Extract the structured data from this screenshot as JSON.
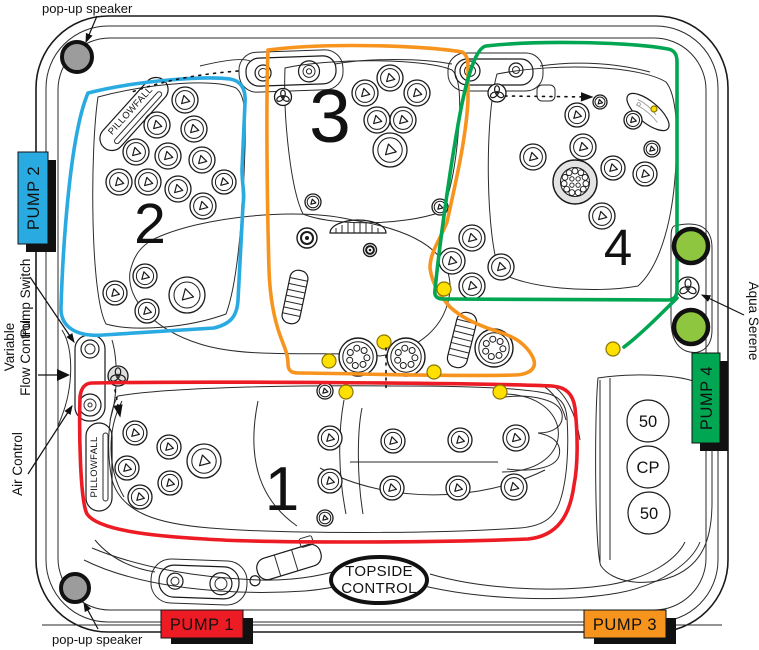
{
  "colors": {
    "line": "#1a1a1a",
    "speaker_gray": "#9c9c9c",
    "led_yellow": "#ffe000",
    "led_outline": "#8a7500",
    "light_green": "#8ec63f",
    "jet_gray": "#e3e3e3"
  },
  "labels": {
    "popup_speaker_top": "pop-up speaker",
    "popup_speaker_bottom": "pop-up speaker",
    "pillowfall_upper": "PILLOWFALL",
    "pillowfall_lower": "PILLOWFALL",
    "pump_switch": "Pump Switch",
    "variable": "Variable",
    "flow_control": "Flow Control",
    "air_control": "Air Control",
    "aqua_serene": "Aqua Serene",
    "topside_line1": "TOPSIDE",
    "topside_line2": "CONTROL"
  },
  "pumps": {
    "pump1": {
      "label": "PUMP 1",
      "color": "#ed1c24"
    },
    "pump2": {
      "label": "PUMP 2",
      "color": "#29abe2"
    },
    "pump3": {
      "label": "PUMP 3",
      "color": "#f7941d"
    },
    "pump4": {
      "label": "PUMP 4",
      "color": "#00a651"
    }
  },
  "zones": {
    "zone1": {
      "number": "1",
      "color": "#ed1c24"
    },
    "zone2": {
      "number": "2",
      "color": "#29abe2"
    },
    "zone3": {
      "number": "3",
      "color": "#f7941d"
    },
    "zone4": {
      "number": "4",
      "color": "#00a651"
    }
  },
  "filter_caps": [
    "50",
    "CP",
    "50"
  ],
  "jets": {
    "standard": [
      [
        185,
        100,
        13
      ],
      [
        157,
        125,
        13
      ],
      [
        194,
        129,
        13
      ],
      [
        136,
        152,
        13
      ],
      [
        168,
        156,
        13
      ],
      [
        202,
        160,
        13
      ],
      [
        119,
        182,
        13
      ],
      [
        148,
        182,
        13
      ],
      [
        178,
        189,
        13
      ],
      [
        224,
        182,
        12
      ],
      [
        203,
        206,
        13
      ],
      [
        145,
        276,
        12
      ],
      [
        115,
        293,
        12
      ],
      [
        147,
        311,
        12
      ],
      [
        187,
        295,
        18
      ],
      [
        365,
        93,
        13
      ],
      [
        390,
        78,
        13
      ],
      [
        417,
        93,
        13
      ],
      [
        377,
        120,
        13
      ],
      [
        403,
        120,
        13
      ],
      [
        390,
        150,
        17
      ],
      [
        313,
        202,
        8
      ],
      [
        440,
        207,
        8
      ],
      [
        533,
        157,
        13
      ],
      [
        583,
        147,
        13
      ],
      [
        577,
        115,
        12
      ],
      [
        600,
        102,
        7
      ],
      [
        633,
        120,
        9
      ],
      [
        613,
        168,
        12
      ],
      [
        645,
        174,
        12
      ],
      [
        652,
        149,
        8
      ],
      [
        602,
        216,
        13
      ],
      [
        472,
        238,
        13
      ],
      [
        452,
        261,
        13
      ],
      [
        501,
        267,
        13
      ],
      [
        472,
        286,
        13
      ],
      [
        135,
        433,
        12
      ],
      [
        169,
        447,
        12
      ],
      [
        127,
        468,
        12
      ],
      [
        170,
        483,
        12
      ],
      [
        140,
        497,
        12
      ],
      [
        204,
        461,
        17
      ],
      [
        330,
        438,
        12
      ],
      [
        393,
        441,
        12
      ],
      [
        460,
        440,
        12
      ],
      [
        516,
        438,
        13
      ],
      [
        330,
        481,
        12
      ],
      [
        392,
        488,
        12
      ],
      [
        458,
        488,
        12
      ],
      [
        514,
        487,
        13
      ],
      [
        325,
        391,
        8
      ],
      [
        325,
        518,
        8
      ]
    ],
    "trilobe": [
      [
        283,
        97,
        8.5,
        0
      ],
      [
        497,
        93,
        9,
        0
      ],
      [
        118,
        376,
        10,
        1
      ],
      [
        688,
        288,
        11,
        0
      ]
    ],
    "double_small": [
      [
        370,
        250,
        6.5
      ],
      [
        307,
        238,
        10
      ]
    ],
    "multihole": [
      [
        358,
        357,
        19
      ],
      [
        406,
        357,
        19
      ],
      [
        494,
        348,
        19
      ]
    ],
    "multihole_gray": [
      [
        575,
        182,
        22
      ]
    ]
  },
  "lights": {
    "yellow": [
      [
        444,
        289,
        7
      ],
      [
        384,
        342,
        7
      ],
      [
        329,
        361,
        7
      ],
      [
        434,
        372,
        7
      ],
      [
        346,
        392,
        7
      ],
      [
        500,
        392,
        7
      ],
      [
        613,
        349,
        7
      ],
      [
        654,
        109,
        3
      ]
    ],
    "green": [
      [
        691,
        246,
        17
      ],
      [
        691,
        327,
        17
      ]
    ]
  },
  "speakers": [
    [
      77,
      57,
      15
    ],
    [
      75,
      588,
      14
    ]
  ]
}
